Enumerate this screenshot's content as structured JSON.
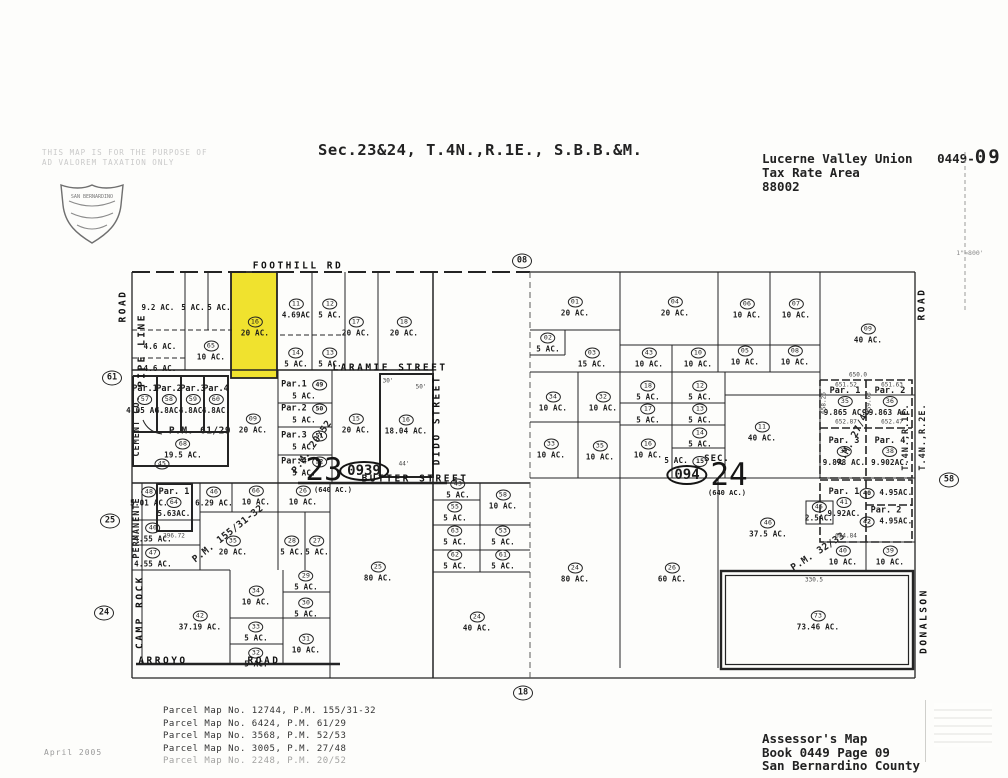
{
  "header": {
    "title": "Sec.23&24, T.4N.,R.1E., S.B.B.&M.",
    "district": "Lucerne Valley Union",
    "book_page_prefix": "0449-",
    "page_big": "09",
    "tax_rate_label": "Tax Rate Area",
    "tax_rate_area": "88002",
    "disclaimer1": "THIS MAP IS FOR THE PURPOSE OF",
    "disclaimer2": "AD VALOREM TAXATION ONLY",
    "seal_name": "SAN BERNARDINO",
    "scale_note": "1\"=800'"
  },
  "map": {
    "highlight_color": "#f0e22e",
    "roads": [
      {
        "label": "FOOTHILL RD",
        "x": 298,
        "y": 266,
        "v": false
      },
      {
        "label": "LARAMIE STREET",
        "x": 390,
        "y": 368,
        "v": false
      },
      {
        "label": "BUTTER STREET",
        "x": 415,
        "y": 479,
        "v": false
      },
      {
        "label": "ARROYO",
        "x": 163,
        "y": 661,
        "v": false
      },
      {
        "label": "ROAD",
        "x": 264,
        "y": 661,
        "v": false
      },
      {
        "label": "DIDO STREET",
        "x": 437,
        "y": 420,
        "v": true
      },
      {
        "label": "ROAD",
        "x": 123,
        "y": 306,
        "v": true
      },
      {
        "label": "PIPE LINE",
        "x": 142,
        "y": 350,
        "v": true
      },
      {
        "label": "CAMP ROCK",
        "x": 140,
        "y": 612,
        "v": true
      },
      {
        "label": "ROAD",
        "x": 922,
        "y": 304,
        "v": true
      },
      {
        "label": "DONALSON",
        "x": 924,
        "y": 621,
        "v": true
      }
    ],
    "side_texts": [
      {
        "t": "T.4N.,R.1E.",
        "x": 906,
        "y": 437
      },
      {
        "t": "T.4N.,R.2E.",
        "x": 923,
        "y": 437
      },
      {
        "t": "CEMENT CO.",
        "x": 137,
        "y": 426
      },
      {
        "t": "PERMANENTE",
        "x": 137,
        "y": 528
      }
    ],
    "pm_labels": [
      {
        "t": "P.M. 61/29",
        "x": 200,
        "y": 431,
        "rot": 0
      },
      {
        "t": "P.M. 155/31-32",
        "x": 228,
        "y": 534,
        "rot": -38
      },
      {
        "t": "P.M. 20/52",
        "x": 312,
        "y": 447,
        "rot": -55
      },
      {
        "t": "P.M. 27/48",
        "x": 854,
        "y": 437,
        "rot": -63
      },
      {
        "t": "P.M. 32/33",
        "x": 818,
        "y": 552,
        "rot": -33
      }
    ],
    "section_labels": [
      {
        "big": "23",
        "bx": 324,
        "by": 470,
        "oval": "0939",
        "ox": 364,
        "oy": 471,
        "note": "(640 AC.)",
        "nx": 333,
        "ny": 490,
        "sec": "",
        "sx": 0,
        "sy": 0
      },
      {
        "big": "24",
        "bx": 729,
        "by": 475,
        "oval": "094",
        "ox": 687,
        "oy": 475,
        "note": "(640 AC.)",
        "nx": 727,
        "ny": 493,
        "sec": "SEC.",
        "sx": 717,
        "sy": 459
      }
    ],
    "edge_markers": [
      {
        "n": "08",
        "x": 522,
        "y": 258
      },
      {
        "n": "18",
        "x": 523,
        "y": 690
      },
      {
        "n": "61",
        "x": 112,
        "y": 375
      },
      {
        "n": "25",
        "x": 110,
        "y": 518
      },
      {
        "n": "24",
        "x": 104,
        "y": 610
      },
      {
        "n": "58",
        "x": 949,
        "y": 477
      }
    ],
    "dims": [
      {
        "t": "651.52",
        "x": 846,
        "y": 385
      },
      {
        "t": "651.63",
        "x": 892,
        "y": 385
      },
      {
        "t": "652.87",
        "x": 846,
        "y": 422
      },
      {
        "t": "652.47",
        "x": 892,
        "y": 422
      },
      {
        "t": "658.26",
        "x": 824,
        "y": 403,
        "v": true
      },
      {
        "t": "659.63",
        "x": 869,
        "y": 403,
        "v": true
      },
      {
        "t": "650.0",
        "x": 858,
        "y": 375
      },
      {
        "t": "654.84",
        "x": 846,
        "y": 536
      },
      {
        "t": "296.72",
        "x": 174,
        "y": 536
      },
      {
        "t": "330.5",
        "x": 814,
        "y": 580
      },
      {
        "t": "30'",
        "x": 388,
        "y": 381
      },
      {
        "t": "50'",
        "x": 421,
        "y": 387
      },
      {
        "t": "44'",
        "x": 404,
        "y": 464
      }
    ],
    "parcels": [
      {
        "ac": "9.2 AC.",
        "x": 158,
        "y": 307
      },
      {
        "ac": "5 AC.",
        "x": 193,
        "y": 307
      },
      {
        "ac": "5 AC.",
        "x": 219,
        "y": 307
      },
      {
        "ac": "4.6 AC.",
        "x": 160,
        "y": 346
      },
      {
        "n": "65",
        "ac": "10 AC.",
        "x": 211,
        "y": 351
      },
      {
        "ac": "4.6 AC.",
        "x": 160,
        "y": 368
      },
      {
        "n": "16",
        "ac": "20 AC.",
        "x": 255,
        "y": 327,
        "highlight": true
      },
      {
        "n": "11",
        "ac": "4.69AC",
        "x": 296,
        "y": 309
      },
      {
        "n": "12",
        "ac": "5 AC.",
        "x": 330,
        "y": 309
      },
      {
        "n": "14",
        "ac": "5 AC.",
        "x": 296,
        "y": 358
      },
      {
        "n": "13",
        "ac": "5 AC.",
        "x": 330,
        "y": 358
      },
      {
        "n": "17",
        "ac": "20 AC.",
        "x": 356,
        "y": 327
      },
      {
        "n": "18",
        "ac": "20 AC.",
        "x": 404,
        "y": 327
      },
      {
        "par": "Par.1",
        "n": "57",
        "ac": "4.05 AC.",
        "x": 145,
        "y": 400
      },
      {
        "par": "Par.2",
        "n": "58",
        "ac": "4.8AC.",
        "x": 169,
        "y": 400
      },
      {
        "par": "Par.3",
        "n": "59",
        "ac": "4.8AC.",
        "x": 193,
        "y": 400
      },
      {
        "par": "Par.4",
        "n": "60",
        "ac": "4.8AC.",
        "x": 216,
        "y": 400
      },
      {
        "n": "68",
        "ac": "19.5 AC.",
        "x": 183,
        "y": 449
      },
      {
        "n": "45",
        "x": 162,
        "y": 464
      },
      {
        "n": "09",
        "ac": "20 AC.",
        "x": 253,
        "y": 424
      },
      {
        "par": "Par.1",
        "n": "49",
        "ac": "5 AC.",
        "x": 304,
        "y": 390,
        "mode": "row"
      },
      {
        "par": "Par.2",
        "n": "50",
        "ac": "5 AC.",
        "x": 304,
        "y": 414,
        "mode": "row"
      },
      {
        "par": "Par.3",
        "n": "51",
        "ac": "5 AC.",
        "x": 304,
        "y": 441,
        "mode": "row"
      },
      {
        "par": "Par.4",
        "n": "52",
        "ac": "5 AC.",
        "x": 304,
        "y": 467,
        "mode": "row"
      },
      {
        "n": "15",
        "ac": "20 AC.",
        "x": 356,
        "y": 424
      },
      {
        "n": "16",
        "ac": "18.04 AC.",
        "x": 406,
        "y": 425
      },
      {
        "n": "48",
        "ac": "5.01 AC.",
        "x": 149,
        "y": 497
      },
      {
        "par": "Par. 1",
        "n": "64",
        "ac": "5.63AC.",
        "x": 174,
        "y": 503
      },
      {
        "n": "46",
        "ac": "6.29 AC.",
        "x": 214,
        "y": 497
      },
      {
        "n": "66",
        "ac": "10 AC.",
        "x": 256,
        "y": 496
      },
      {
        "n": "26",
        "ac": "10 AC.",
        "x": 303,
        "y": 496
      },
      {
        "n": "40",
        "ac": "4.55 AC.",
        "x": 153,
        "y": 533
      },
      {
        "n": "47",
        "ac": "4.55 AC.",
        "x": 153,
        "y": 558
      },
      {
        "n": "35",
        "ac": "20 AC.",
        "x": 233,
        "y": 546
      },
      {
        "n": "28",
        "ac": "5 AC.",
        "x": 292,
        "y": 546
      },
      {
        "n": "27",
        "ac": "5 AC.",
        "x": 317,
        "y": 546
      },
      {
        "n": "29",
        "ac": "5 AC.",
        "x": 306,
        "y": 581
      },
      {
        "n": "34",
        "ac": "10 AC.",
        "x": 256,
        "y": 596
      },
      {
        "n": "30",
        "ac": "5 AC.",
        "x": 306,
        "y": 608
      },
      {
        "n": "33",
        "ac": "5 AC.",
        "x": 256,
        "y": 632
      },
      {
        "n": "31",
        "ac": "10 AC.",
        "x": 306,
        "y": 644
      },
      {
        "n": "32",
        "ac": "5 AC.",
        "x": 256,
        "y": 658
      },
      {
        "n": "42",
        "ac": "37.19 AC.",
        "x": 200,
        "y": 621
      },
      {
        "n": "25",
        "ac": "80 AC.",
        "x": 378,
        "y": 572
      },
      {
        "n": "43",
        "ac": "5 AC.",
        "x": 458,
        "y": 489
      },
      {
        "n": "58",
        "ac": "10 AC.",
        "x": 503,
        "y": 500
      },
      {
        "n": "55",
        "ac": "5 AC.",
        "x": 455,
        "y": 512
      },
      {
        "n": "63",
        "ac": "5 AC.",
        "x": 455,
        "y": 536
      },
      {
        "n": "53",
        "ac": "5 AC.",
        "x": 503,
        "y": 536
      },
      {
        "n": "62",
        "ac": "5 AC.",
        "x": 455,
        "y": 560
      },
      {
        "n": "61",
        "ac": "5 AC.",
        "x": 503,
        "y": 560
      },
      {
        "n": "24",
        "ac": "40 AC.",
        "x": 477,
        "y": 622
      },
      {
        "n": "01",
        "ac": "20 AC.",
        "x": 575,
        "y": 307
      },
      {
        "n": "04",
        "ac": "20 AC.",
        "x": 675,
        "y": 307
      },
      {
        "n": "06",
        "ac": "10 AC.",
        "x": 747,
        "y": 309
      },
      {
        "n": "07",
        "ac": "10 AC.",
        "x": 796,
        "y": 309
      },
      {
        "n": "09",
        "ac": "40 AC.",
        "x": 868,
        "y": 334
      },
      {
        "n": "02",
        "ac": "5 AC.",
        "x": 548,
        "y": 343
      },
      {
        "n": "03",
        "ac": "15 AC.",
        "x": 592,
        "y": 358
      },
      {
        "n": "43",
        "ac": "10 AC.",
        "x": 649,
        "y": 358
      },
      {
        "n": "10",
        "ac": "10 AC.",
        "x": 698,
        "y": 358
      },
      {
        "n": "05",
        "ac": "10 AC.",
        "x": 745,
        "y": 356
      },
      {
        "n": "08",
        "ac": "10 AC.",
        "x": 795,
        "y": 356
      },
      {
        "n": "34",
        "ac": "10 AC.",
        "x": 553,
        "y": 402
      },
      {
        "n": "32",
        "ac": "10 AC.",
        "x": 603,
        "y": 402
      },
      {
        "n": "18",
        "ac": "5 AC.",
        "x": 648,
        "y": 391
      },
      {
        "n": "12",
        "ac": "5 AC.",
        "x": 700,
        "y": 391
      },
      {
        "n": "17",
        "ac": "5 AC.",
        "x": 648,
        "y": 414
      },
      {
        "n": "13",
        "ac": "5 AC.",
        "x": 700,
        "y": 414
      },
      {
        "n": "14",
        "ac": "5 AC.",
        "x": 700,
        "y": 438
      },
      {
        "n": "33",
        "ac": "10 AC.",
        "x": 551,
        "y": 449
      },
      {
        "n": "35",
        "ac": "10 AC.",
        "x": 600,
        "y": 451
      },
      {
        "n": "16",
        "ac": "10 AC.",
        "x": 648,
        "y": 449
      },
      {
        "n": "15",
        "ac": "5 AC.",
        "x": 686,
        "y": 461,
        "mode": "acfirst"
      },
      {
        "n": "11",
        "ac": "40 AC.",
        "x": 762,
        "y": 432
      },
      {
        "n": "46",
        "ac": "37.5 AC.",
        "x": 768,
        "y": 528
      },
      {
        "n": "45",
        "ac": "2.5AC.",
        "x": 819,
        "y": 512
      },
      {
        "par": "Par. 1",
        "n": "35",
        "ac": "9.865 AC.",
        "x": 845,
        "y": 402
      },
      {
        "par": "Par. 2",
        "n": "36",
        "ac": "9.863 AC.",
        "x": 890,
        "y": 402
      },
      {
        "par": "Par. 3",
        "n": "37",
        "ac": "9.878 AC.",
        "x": 844,
        "y": 452
      },
      {
        "par": "Par. 4",
        "n": "38",
        "ac": "9.902AC.",
        "x": 890,
        "y": 452
      },
      {
        "par": "Par. 1",
        "n": "41",
        "ac": "9.92AC.",
        "x": 844,
        "y": 503
      },
      {
        "n": "40",
        "ac": "4.95AC.",
        "x": 886,
        "y": 493,
        "mode": "inline"
      },
      {
        "par": "Par. 2",
        "n": "42",
        "ac": "4.95AC.",
        "x": 886,
        "y": 517,
        "mode": "inline"
      },
      {
        "n": "24",
        "ac": "80 AC.",
        "x": 575,
        "y": 573
      },
      {
        "n": "26",
        "ac": "60 AC.",
        "x": 672,
        "y": 573
      },
      {
        "n": "40",
        "ac": "10 AC.",
        "x": 843,
        "y": 556
      },
      {
        "n": "39",
        "ac": "10 AC.",
        "x": 890,
        "y": 556
      },
      {
        "n": "73",
        "ac": "73.46 AC.",
        "x": 818,
        "y": 621
      }
    ]
  },
  "footer": {
    "parcel_maps": [
      {
        "text": "Parcel Map No. 12744, P.M. 155/31-32",
        "faint": false
      },
      {
        "text": "Parcel Map No. 6424, P.M. 61/29",
        "faint": false
      },
      {
        "text": "Parcel Map No. 3568, P.M. 52/53",
        "faint": false
      },
      {
        "text": "Parcel Map No. 3005, P.M. 27/48",
        "faint": false
      },
      {
        "text": "Parcel Map No. 2248, P.M. 20/52",
        "faint": true
      }
    ],
    "assessor_line1": "Assessor's Map",
    "assessor_line2": "Book 0449 Page 09",
    "assessor_line3": "San Bernardino County",
    "date": "April 2005"
  }
}
